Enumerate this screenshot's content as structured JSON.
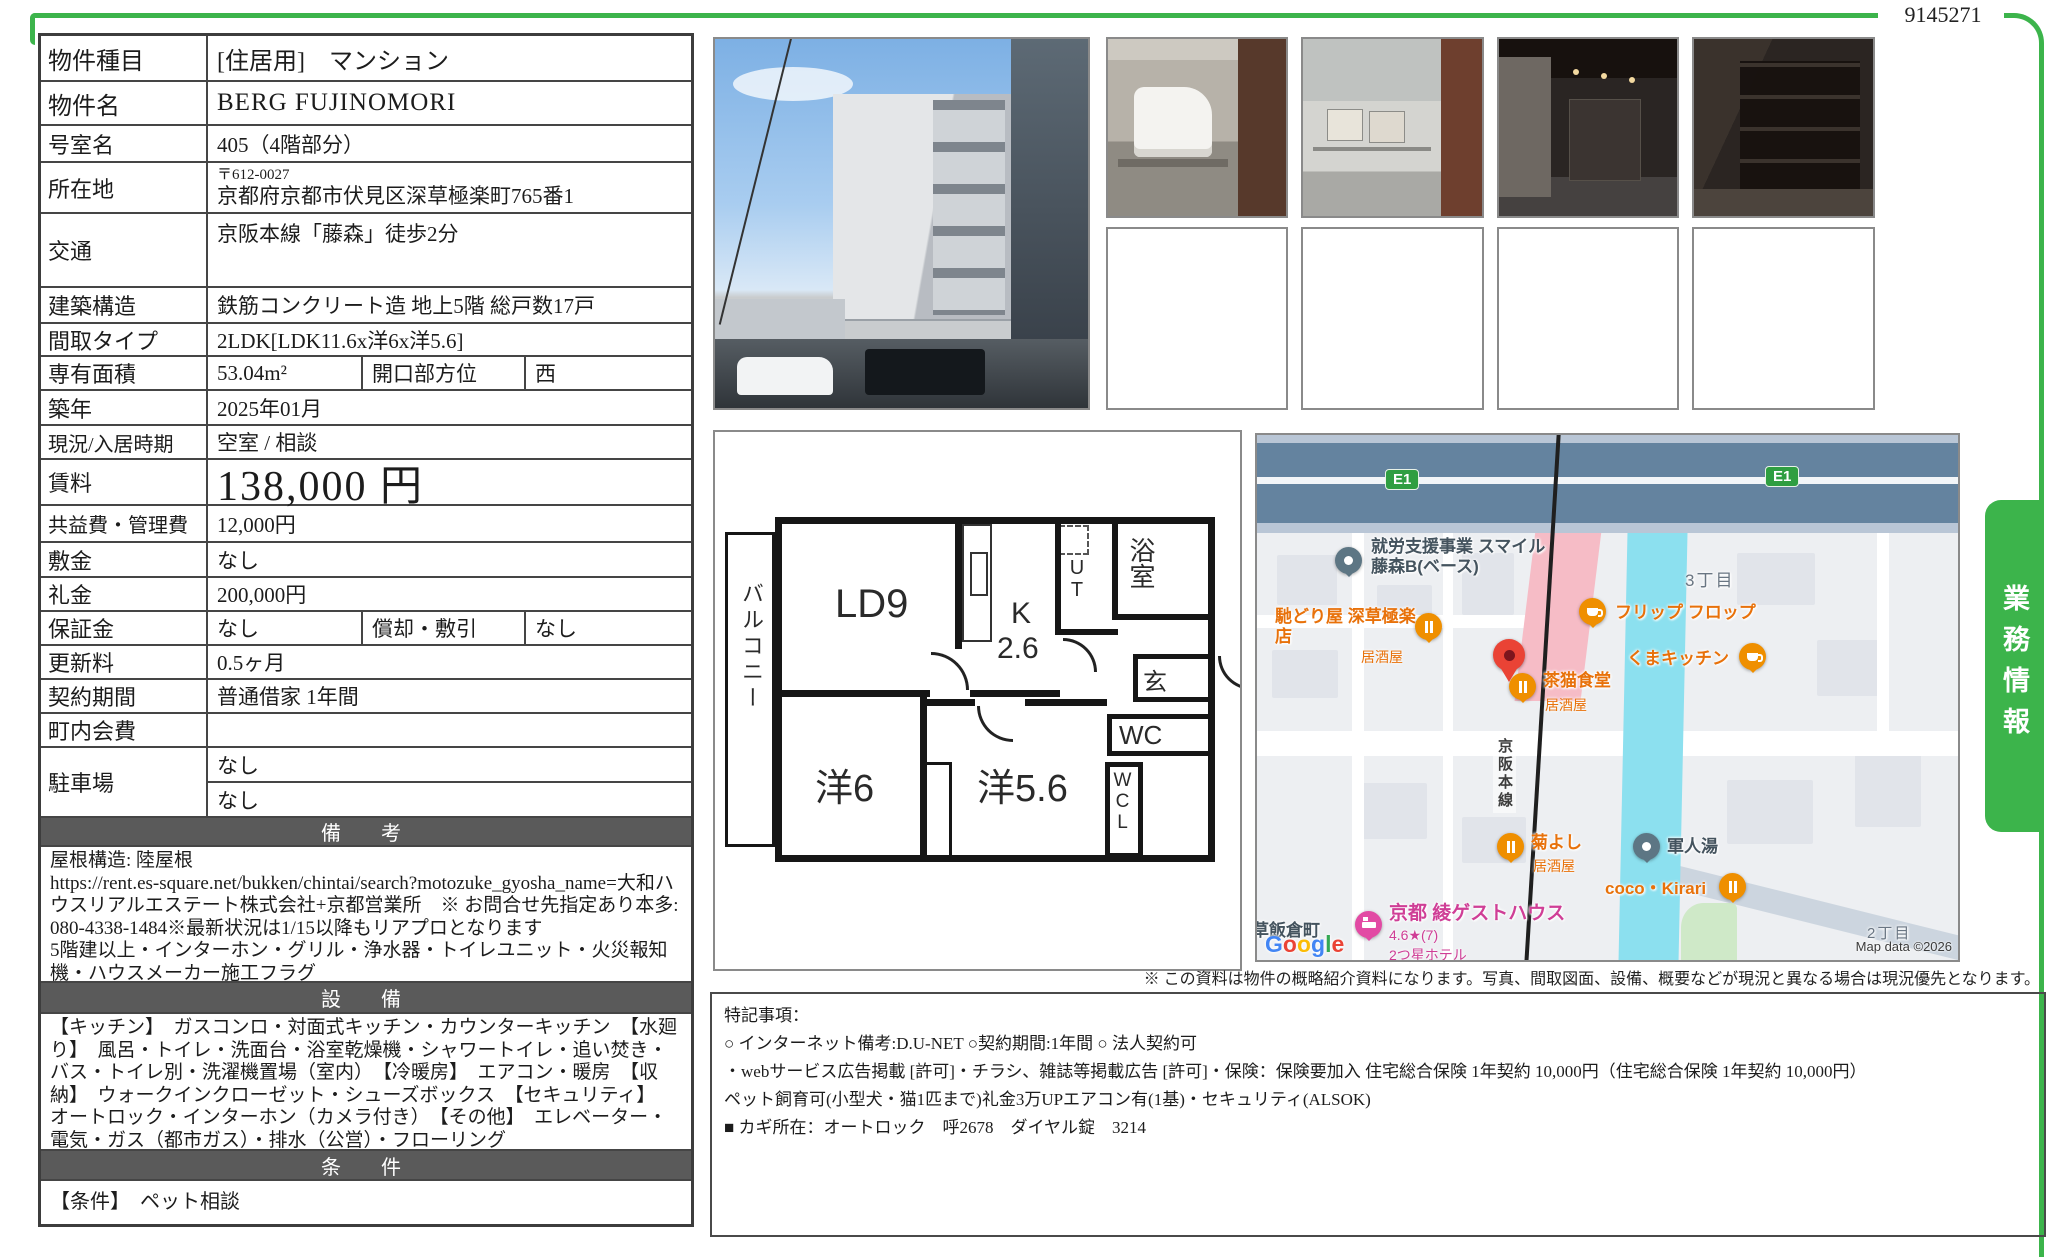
{
  "doc": {
    "number": "9145271"
  },
  "tab": {
    "label": "業務情報"
  },
  "colors": {
    "accent_green": "#3cb44b",
    "header_gray": "#5a5a5a",
    "map_highway": "#64839f",
    "map_river": "#8ce0ef",
    "poi_orange": "#ef8f00",
    "marker_red": "#ea4335",
    "hotel_pink": "#e24aa4"
  },
  "table": {
    "rows": [
      {
        "label": "物件種目",
        "value": "[住居用]　マンション"
      },
      {
        "label": "物件名",
        "value": "BERG FUJINOMORI"
      },
      {
        "label": "号室名",
        "value": "405（4階部分）"
      },
      {
        "label": "所在地",
        "postal": "〒612-0027",
        "value": "京都府京都市伏見区深草極楽町765番1"
      },
      {
        "label": "交通",
        "value": "京阪本線「藤森」徒歩2分"
      },
      {
        "label": "建築構造",
        "value": "鉄筋コンクリート造 地上5階 総戸数17戸"
      },
      {
        "label": "間取タイプ",
        "value": "2LDK[LDK11.6x洋6x洋5.6]"
      },
      {
        "label": "専有面積",
        "value": "53.04m²",
        "label2": "開口部方位",
        "value2": "西"
      },
      {
        "label": "築年",
        "value": "2025年01月"
      },
      {
        "label": "現況/入居時期",
        "value": "空室 / 相談"
      },
      {
        "label": "賃料",
        "value": "138,000 円"
      },
      {
        "label": "共益費・管理費",
        "value": "12,000円"
      },
      {
        "label": "敷金",
        "value": "なし"
      },
      {
        "label": "礼金",
        "value": "200,000円"
      },
      {
        "label": "保証金",
        "value": "なし",
        "label2": "償却・敷引",
        "value2": "なし"
      },
      {
        "label": "更新料",
        "value": "0.5ヶ月"
      },
      {
        "label": "契約期間",
        "value": "普通借家 1年間"
      },
      {
        "label": "町内会費",
        "value": ""
      },
      {
        "label": "駐車場",
        "value1": "なし",
        "value2": "なし"
      }
    ]
  },
  "sections": {
    "remarks_header": "備　考",
    "remarks": "屋根構造: 陸屋根\nhttps://rent.es-square.net/bukken/chintai/search?motozuke_gyosha_name=大和ハウスリアルエステート株式会社+京都営業所　※ お問合せ先指定あり本多:080-4338-1484※最新状況は1/15以降もリアプロとなります\n5階建以上・インターホン・グリル・浄水器・トイレユニット・火災報知機・ハウスメーカー施工フラグ",
    "equipment_header": "設　備",
    "equipment": "【キッチン】　ガスコンロ・対面式キッチン・カウンターキッチン　【水廻り】　風呂・トイレ・洗面台・浴室乾燥機・シャワートイレ・追い焚き・バス・トイレ別・洗濯機置場（室内）　【冷暖房】　エアコン・暖房　【収納】　ウォークインクローゼット・シューズボックス　【セキュリティ】　オートロック・インターホン（カメラ付き）　【その他】　エレベーター・電気・ガス（都市ガス）・排水（公営）・フローリング",
    "conditions_header": "条　件",
    "conditions": "【条件】　ペット相談"
  },
  "floorplan": {
    "living": "LD9",
    "kitchen": "K",
    "kitchen_size": "2.6",
    "ut": "UT",
    "bath": "浴室",
    "entrance": "玄",
    "wc": "WC",
    "bed1": "洋6",
    "bed2": "洋5.6",
    "wcl": "WCL",
    "balcony": "バルコニー"
  },
  "map": {
    "shield1": "E1",
    "shield2": "E1",
    "rail": "京阪本線",
    "district3": "3丁目",
    "district2": "2丁目",
    "town": "深草飯倉町",
    "poi_support": "就労支援事業 スマイル\n藤森B(ベース)",
    "poi_hashidoriya": "馳どり屋 深草極楽店",
    "izakaya1": "居酒屋",
    "poi_flipflop": "フリップ フロップ",
    "poi_kuma": "くまキッチン",
    "poi_chaneko": "茶猫食堂",
    "izakaya2": "居酒屋",
    "poi_kikuyoshi": "菊よし",
    "izakaya3": "居酒屋",
    "poi_gunjinyu": "軍人湯",
    "poi_coco": "coco・Kirari",
    "poi_guesthouse": "京都 綾ゲストハウス",
    "guesthouse_rating": "4.6★(7)",
    "guesthouse_type": "2つ星ホテル",
    "google_letters": [
      "G",
      "o",
      "o",
      "g",
      "l",
      "e"
    ],
    "copyright": "Map data ©2026"
  },
  "notes": {
    "disclaimer": "※ この資料は物件の概略紹介資料になります。写真、間取図面、設備、概要などが現況と異なる場合は現況優先となります。",
    "special": "特記事項：\n○ インターネット備考:D.U-NET ○契約期間:1年間 ○ 法人契約可\n・webサービス広告掲載 [許可]・チラシ、雑誌等掲載広告 [許可]・保険：保険要加入 住宅総合保険 1年契約 10,000円（住宅総合保険 1年契約 10,000円）\nペット飼育可(小型犬・猫1匹まで)礼金3万UPエアコン有(1基)・セキュリティ(ALSOK)\n■ カギ所在：オートロック　呼2678　ダイヤル錠　3214"
  }
}
